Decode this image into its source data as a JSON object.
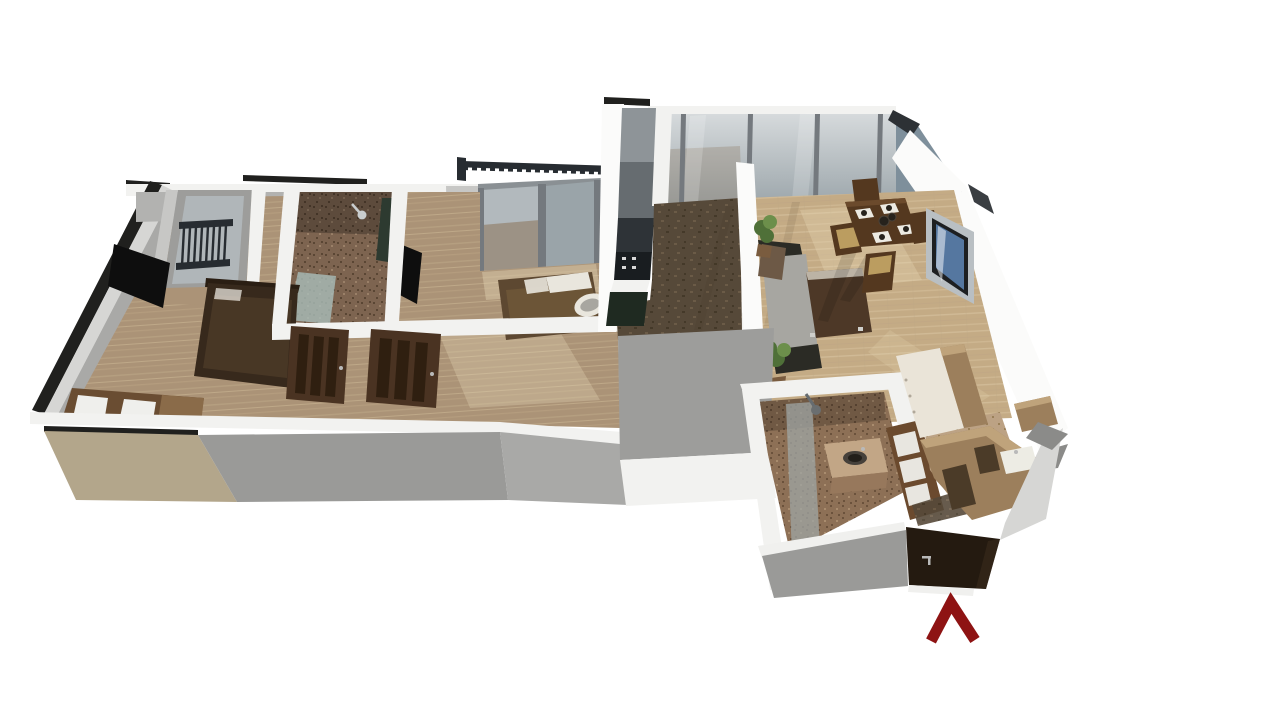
{
  "scene": {
    "kind": "3d-floorplan-render",
    "entrance_arrow": {
      "glyph": "Λ",
      "direction": "up-toward-entrance-door"
    }
  },
  "colors": {
    "background": "#ffffff",
    "wall_white": "#f2f2f0",
    "wall_white_bright": "#fbfbfa",
    "wall_face_light": "#d6d6d4",
    "wall_face_mid": "#a9a9a7",
    "wall_face_gray": "#9a9a98",
    "wall_face_dark": "#8b8b89",
    "wall_cap_black": "#20201e",
    "facade_beige": "#b3a68b",
    "interior_wall_gray": "#9d9d9b",
    "interior_wall_light": "#c7c7c5",
    "back_wall_gray": "#b2b2b0",
    "floor_wood_light": "#c4ab85",
    "floor_wood_streak": "#d6c19d",
    "floor_wood_dark": "#ab9377",
    "floor_wood_dark_streak": "#bda685",
    "tile_dark": "#564939",
    "tile_speck_a": "#6b5b47",
    "tile_speck_b": "#443929",
    "mosaic_base": "#7d6450",
    "mosaic_dark": "#5a4634",
    "mosaic_light": "#9a8068",
    "mosaic2_base": "#8d7056",
    "mosaic2_dark": "#6b523c",
    "mosaic2_light": "#a98c6e",
    "mosaic_floor_light": "#bca284",
    "mosaic_floor_speck": "#9a8059",
    "glass_light": "#d6dadc",
    "glass_mid": "#b2b9bd",
    "glass_dark": "#9aa4a9",
    "glass_steel": "#7e8f9b",
    "glass_mullion": "#74797e",
    "glass_frame_light": "#8a9094",
    "glass_reflect_brown": "#93826e",
    "window_frame_light": "#b9bfc3",
    "window_frame_dark": "#1d1f21",
    "window_glass_blue": "#5577a0",
    "railing_dark": "#272c31",
    "door_walnut": "#4a3322",
    "door_panel_dark": "#2f1f10",
    "entry_door": "#241a10",
    "door_louver_frame": "#6b4a2e",
    "louver_white": "#e8e6e0",
    "tv_black": "#0e0e0e",
    "bed1_dark": "#37291c",
    "bed1_blanket": "#4a3827",
    "bed1_headboard": "#2a1e13",
    "bed2_brown": "#5d4831",
    "bed2_blanket": "#6e5638",
    "pillow_white": "#e9e6dd",
    "nightstand_light": "#dcdcd8",
    "desk_wood": "#6a4d32",
    "desk_wood_light": "#8a6b49",
    "chair_white": "#efefec",
    "sofa_seat": "#a7a6a1",
    "sofa_dark": "#2b2b25",
    "sofa_pillow": "#6d5946",
    "coffee_top": "#4d3827",
    "coffee_glass": "#d8d2c6",
    "dining_wood": "#54381f",
    "dining_wood_light": "#6b4a2c",
    "chair_seat_tan": "#bb9d60",
    "placemat_white": "#eceae2",
    "food_dark": "#26221c",
    "plant_green": "#4f7038",
    "plant_green_light": "#6c8f4b",
    "plant_pot": "#7a5c3f",
    "counter_green": "#1f2a21",
    "appliance_light": "#8e9498",
    "appliance_mid": "#666c70",
    "appliance_dark": "#2e3337",
    "cooktop_black": "#191d20",
    "kitchen_wood": "#9c7f5c",
    "kitchen_wood_light": "#bfa37b",
    "kitchen_wood_dark": "#4b3b28",
    "kitchen_side_white": "#eae4d8",
    "sink_white": "#edece4",
    "vanity_tan": "#c2a686",
    "vanity_face": "#97785c",
    "sink_dark": "#45403a",
    "sink_dark_inner": "#231f1a",
    "shower_glass": "#a9bdb9",
    "shower_glass2": "#9fa6a4",
    "glass_green_dark": "#2d3a30",
    "metal_gray": "#c9cdce",
    "sun_patch": "#e8d9b8",
    "threshold_white": "#f0f0ee",
    "handle_silver": "#b9b9b9",
    "arrow_red": "#8e1313"
  }
}
